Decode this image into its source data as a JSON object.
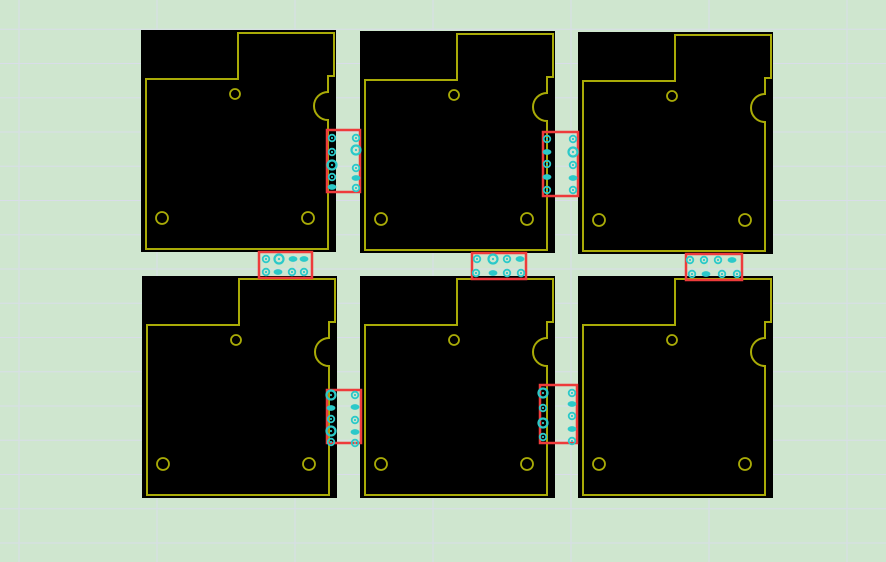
{
  "canvas": {
    "width": 886,
    "height": 562
  },
  "colors": {
    "background": "#cfe6cf",
    "grid_line": "#d9dde9",
    "board_fill": "#000000",
    "board_outline": "#a9ab07",
    "tab_outline": "#ee3b3b",
    "drill_mark": "#2bc9c9"
  },
  "grid": {
    "x_start": 19,
    "x_step": 138,
    "y_start": 29.3,
    "y_step": 34.25
  },
  "board_template": {
    "width": 195,
    "height": 222,
    "outline_path": "M 5 49 H 97 V 3 H 193 V 46 H 187 V 62 A 14 14 0 0 0 187 90 V 219 H 5 Z",
    "holes": [
      {
        "cx": 94,
        "cy": 64,
        "r": 5
      },
      {
        "cx": 21,
        "cy": 188,
        "r": 6
      },
      {
        "cx": 167,
        "cy": 188,
        "r": 6
      }
    ]
  },
  "boards": [
    {
      "id": "pcb-board-1",
      "x": 141,
      "y": 30
    },
    {
      "id": "pcb-board-2",
      "x": 360,
      "y": 31
    },
    {
      "id": "pcb-board-3",
      "x": 578,
      "y": 32
    },
    {
      "id": "pcb-board-4",
      "x": 142,
      "y": 276
    },
    {
      "id": "pcb-board-5",
      "x": 360,
      "y": 276
    },
    {
      "id": "pcb-board-6",
      "x": 578,
      "y": 276
    }
  ],
  "tabs": [
    {
      "id": "breakout-tab-1-2",
      "rect": {
        "x": 327,
        "y": 130,
        "w": 33,
        "h": 62
      },
      "holes": [
        {
          "x": 332,
          "y": 138,
          "t": "ring"
        },
        {
          "x": 332,
          "y": 152,
          "t": "ring"
        },
        {
          "x": 332,
          "y": 165,
          "t": "big"
        },
        {
          "x": 332,
          "y": 177,
          "t": "ring"
        },
        {
          "x": 332,
          "y": 187,
          "t": "oval"
        },
        {
          "x": 356,
          "y": 138,
          "t": "ring"
        },
        {
          "x": 356,
          "y": 150,
          "t": "big"
        },
        {
          "x": 356,
          "y": 168,
          "t": "ring"
        },
        {
          "x": 356,
          "y": 178,
          "t": "oval"
        },
        {
          "x": 356,
          "y": 188,
          "t": "ring"
        }
      ]
    },
    {
      "id": "breakout-tab-2-3",
      "rect": {
        "x": 543,
        "y": 132,
        "w": 35,
        "h": 64
      },
      "holes": [
        {
          "x": 547,
          "y": 139,
          "t": "ring"
        },
        {
          "x": 547,
          "y": 152,
          "t": "oval"
        },
        {
          "x": 547,
          "y": 164,
          "t": "ring"
        },
        {
          "x": 547,
          "y": 177,
          "t": "oval"
        },
        {
          "x": 547,
          "y": 190,
          "t": "ring"
        },
        {
          "x": 573,
          "y": 139,
          "t": "ring"
        },
        {
          "x": 573,
          "y": 152,
          "t": "big"
        },
        {
          "x": 573,
          "y": 165,
          "t": "ring"
        },
        {
          "x": 573,
          "y": 178,
          "t": "oval"
        },
        {
          "x": 573,
          "y": 190,
          "t": "ring"
        }
      ]
    },
    {
      "id": "breakout-tab-4-5",
      "rect": {
        "x": 327,
        "y": 390,
        "w": 34,
        "h": 53
      },
      "holes": [
        {
          "x": 331,
          "y": 395,
          "t": "big"
        },
        {
          "x": 331,
          "y": 408,
          "t": "oval"
        },
        {
          "x": 331,
          "y": 419,
          "t": "ring"
        },
        {
          "x": 331,
          "y": 431,
          "t": "big"
        },
        {
          "x": 331,
          "y": 442,
          "t": "ring"
        },
        {
          "x": 355,
          "y": 395,
          "t": "ring"
        },
        {
          "x": 355,
          "y": 407,
          "t": "oval"
        },
        {
          "x": 355,
          "y": 420,
          "t": "ring"
        },
        {
          "x": 355,
          "y": 432,
          "t": "oval"
        },
        {
          "x": 355,
          "y": 443,
          "t": "ring"
        }
      ]
    },
    {
      "id": "breakout-tab-5-6",
      "rect": {
        "x": 540,
        "y": 385,
        "w": 37,
        "h": 58
      },
      "holes": [
        {
          "x": 543,
          "y": 393,
          "t": "big"
        },
        {
          "x": 543,
          "y": 408,
          "t": "ring"
        },
        {
          "x": 543,
          "y": 423,
          "t": "big"
        },
        {
          "x": 543,
          "y": 437,
          "t": "ring"
        },
        {
          "x": 572,
          "y": 393,
          "t": "ring"
        },
        {
          "x": 572,
          "y": 404,
          "t": "oval"
        },
        {
          "x": 572,
          "y": 416,
          "t": "ring"
        },
        {
          "x": 572,
          "y": 429,
          "t": "oval"
        },
        {
          "x": 572,
          "y": 441,
          "t": "ring"
        }
      ]
    },
    {
      "id": "breakout-tab-1-4",
      "rect": {
        "x": 259,
        "y": 252,
        "w": 53,
        "h": 26
      },
      "holes": [
        {
          "x": 266,
          "y": 259,
          "t": "ring"
        },
        {
          "x": 279,
          "y": 259,
          "t": "big"
        },
        {
          "x": 293,
          "y": 259,
          "t": "oval"
        },
        {
          "x": 304,
          "y": 259,
          "t": "oval"
        },
        {
          "x": 266,
          "y": 272,
          "t": "ring"
        },
        {
          "x": 278,
          "y": 272,
          "t": "oval"
        },
        {
          "x": 292,
          "y": 272,
          "t": "ring"
        },
        {
          "x": 304,
          "y": 272,
          "t": "ring"
        }
      ]
    },
    {
      "id": "breakout-tab-2-5",
      "rect": {
        "x": 472,
        "y": 253,
        "w": 54,
        "h": 26
      },
      "holes": [
        {
          "x": 477,
          "y": 259,
          "t": "ring"
        },
        {
          "x": 493,
          "y": 259,
          "t": "big"
        },
        {
          "x": 507,
          "y": 259,
          "t": "ring"
        },
        {
          "x": 520,
          "y": 259,
          "t": "oval"
        },
        {
          "x": 476,
          "y": 273,
          "t": "ring"
        },
        {
          "x": 493,
          "y": 273,
          "t": "oval"
        },
        {
          "x": 507,
          "y": 273,
          "t": "ring"
        },
        {
          "x": 521,
          "y": 273,
          "t": "ring"
        }
      ]
    },
    {
      "id": "breakout-tab-3-6",
      "rect": {
        "x": 686,
        "y": 254,
        "w": 56,
        "h": 26
      },
      "holes": [
        {
          "x": 690,
          "y": 260,
          "t": "ring"
        },
        {
          "x": 704,
          "y": 260,
          "t": "ring"
        },
        {
          "x": 718,
          "y": 260,
          "t": "ring"
        },
        {
          "x": 732,
          "y": 260,
          "t": "oval"
        },
        {
          "x": 692,
          "y": 274,
          "t": "ring"
        },
        {
          "x": 706,
          "y": 274,
          "t": "oval"
        },
        {
          "x": 722,
          "y": 274,
          "t": "ring"
        },
        {
          "x": 737,
          "y": 274,
          "t": "ring"
        }
      ]
    }
  ]
}
